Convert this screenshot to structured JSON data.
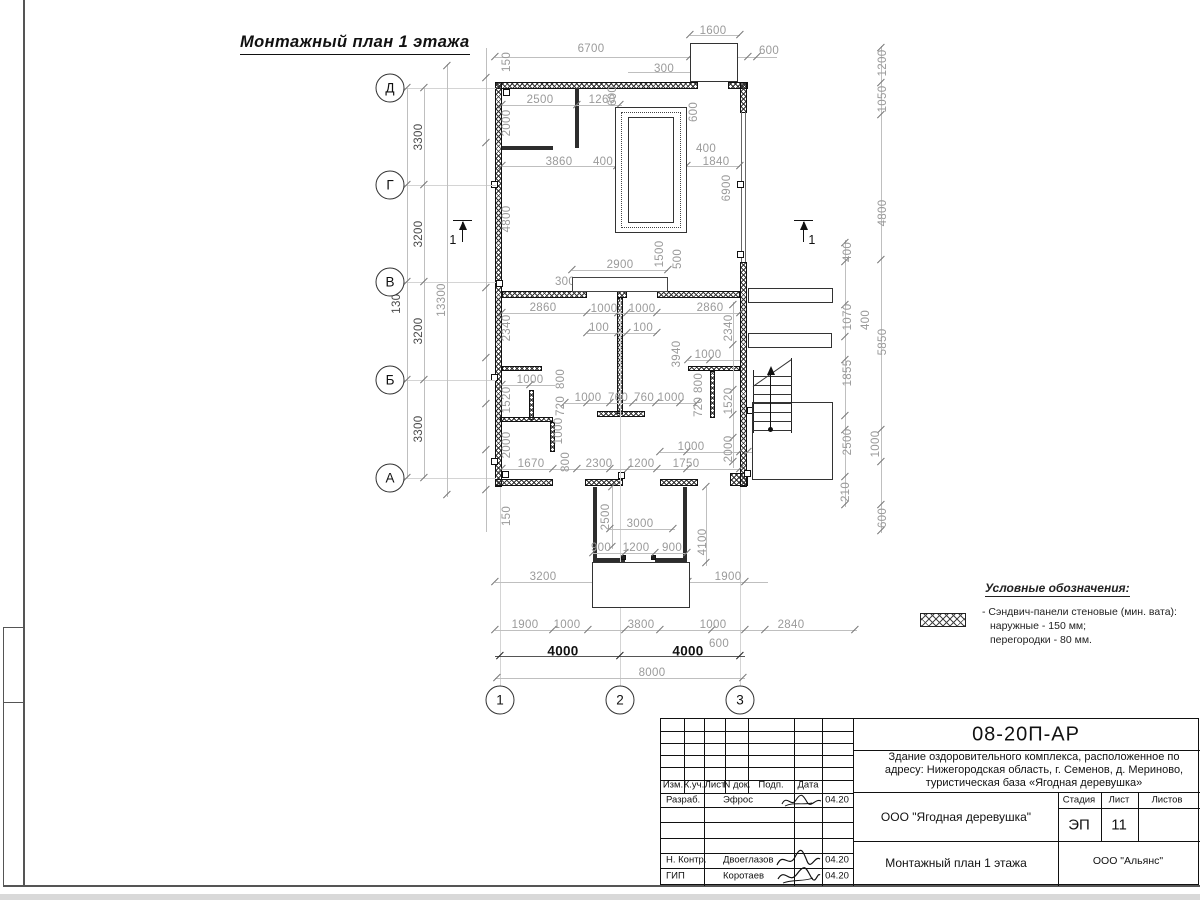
{
  "page": {
    "title": "Монтажный план 1 этажа",
    "section_mark_label": "1"
  },
  "legend": {
    "title": "Условные обозначения:",
    "item_line1": "- Сэндвич-панели стеновые (мин. вата):",
    "item_line2": "наружные - 150 мм;",
    "item_line3": "перегородки - 80 мм.",
    "swatch": "crosshatch-wall-symbol"
  },
  "title_block": {
    "code": "08-20П-АР",
    "project_line1": "Здание оздоровительного комплекса, расположенное по",
    "project_line2": "адресу: Нижегородская область, г. Семенов, д. Мериново,",
    "project_line3": "туристическая база «Ягодная деревушка»",
    "client": "ООО \"Ягодная деревушка\"",
    "stage_label": "Стадия",
    "sheet_label": "Лист",
    "sheets_label": "Листов",
    "stage": "ЭП",
    "sheet": "11",
    "drawing_title": "Монтажный план 1 этажа",
    "company": "ООО \"Альянс\"",
    "header": {
      "izm": "Изм.",
      "kuch": "К.уч.",
      "list": "Лист",
      "ndok": "N док.",
      "podp": "Подп.",
      "data": "Дата"
    },
    "rows": [
      {
        "role": "Разраб.",
        "name": "Эфрос",
        "date": "04.20"
      },
      {
        "role": "Н. Контр.",
        "name": "Двоеглазов",
        "date": "04.20"
      },
      {
        "role": "ГИП",
        "name": "Коротаев",
        "date": "04.20"
      }
    ]
  },
  "plan": {
    "axes": {
      "rows": [
        {
          "label": "Д",
          "y": 88
        },
        {
          "label": "Г",
          "y": 185
        },
        {
          "label": "В",
          "y": 282
        },
        {
          "label": "Б",
          "y": 380
        },
        {
          "label": "А",
          "y": 478
        }
      ],
      "cols": [
        {
          "label": "1",
          "x": 500
        },
        {
          "label": "2",
          "x": 620
        },
        {
          "label": "3",
          "x": 740
        }
      ]
    },
    "dimensions": [
      {
        "t": "3300",
        "x": 419,
        "y": 137,
        "r": 1,
        "s": "d"
      },
      {
        "t": "3200",
        "x": 419,
        "y": 234,
        "r": 1,
        "s": "d"
      },
      {
        "t": "3200",
        "x": 419,
        "y": 331,
        "r": 1,
        "s": "d"
      },
      {
        "t": "3300",
        "x": 419,
        "y": 429,
        "r": 1,
        "s": "d"
      },
      {
        "t": "13000",
        "x": 397,
        "y": 297,
        "r": 1,
        "s": "d"
      },
      {
        "t": "13300",
        "x": 442,
        "y": 300,
        "r": 1
      },
      {
        "t": "150",
        "x": 507,
        "y": 62,
        "r": 1
      },
      {
        "t": "2000",
        "x": 507,
        "y": 123,
        "r": 1
      },
      {
        "t": "4800",
        "x": 507,
        "y": 219,
        "r": 1
      },
      {
        "t": "2340",
        "x": 507,
        "y": 328,
        "r": 1
      },
      {
        "t": "1520",
        "x": 507,
        "y": 400,
        "r": 1
      },
      {
        "t": "2000",
        "x": 507,
        "y": 445,
        "r": 1
      },
      {
        "t": "150",
        "x": 507,
        "y": 516,
        "r": 1
      },
      {
        "t": "1600",
        "x": 713,
        "y": 31
      },
      {
        "t": "6700",
        "x": 591,
        "y": 49
      },
      {
        "t": "1000",
        "x": 712,
        "y": 51
      },
      {
        "t": "600",
        "x": 769,
        "y": 51
      },
      {
        "t": "300",
        "x": 664,
        "y": 69
      },
      {
        "t": "2500",
        "x": 540,
        "y": 100
      },
      {
        "t": "1260",
        "x": 602,
        "y": 100
      },
      {
        "t": "600",
        "x": 613,
        "y": 96,
        "r": 1
      },
      {
        "t": "600",
        "x": 694,
        "y": 112,
        "r": 1
      },
      {
        "t": "3860",
        "x": 559,
        "y": 162
      },
      {
        "t": "400",
        "x": 603,
        "y": 162
      },
      {
        "t": "1500",
        "x": 655,
        "y": 162
      },
      {
        "t": "400",
        "x": 706,
        "y": 149
      },
      {
        "t": "1840",
        "x": 716,
        "y": 162
      },
      {
        "t": "400",
        "x": 647,
        "y": 136,
        "r": 1
      },
      {
        "t": "3500",
        "x": 661,
        "y": 141,
        "r": 1
      },
      {
        "t": "400",
        "x": 662,
        "y": 209,
        "r": 1
      },
      {
        "t": "6900",
        "x": 727,
        "y": 188,
        "r": 1
      },
      {
        "t": "1500",
        "x": 660,
        "y": 254,
        "r": 1
      },
      {
        "t": "500",
        "x": 678,
        "y": 259,
        "r": 1
      },
      {
        "t": "2900",
        "x": 620,
        "y": 265
      },
      {
        "t": "300",
        "x": 565,
        "y": 282
      },
      {
        "t": "2860",
        "x": 543,
        "y": 308
      },
      {
        "t": "1000",
        "x": 604,
        "y": 309
      },
      {
        "t": "1000",
        "x": 642,
        "y": 309
      },
      {
        "t": "2860",
        "x": 710,
        "y": 308
      },
      {
        "t": "100",
        "x": 599,
        "y": 328
      },
      {
        "t": "100",
        "x": 643,
        "y": 328
      },
      {
        "t": "2340",
        "x": 729,
        "y": 328,
        "r": 1
      },
      {
        "t": "3940",
        "x": 677,
        "y": 354,
        "r": 1
      },
      {
        "t": "1000",
        "x": 708,
        "y": 355
      },
      {
        "t": "1000",
        "x": 530,
        "y": 380
      },
      {
        "t": "800",
        "x": 561,
        "y": 379,
        "r": 1
      },
      {
        "t": "720",
        "x": 561,
        "y": 406,
        "r": 1
      },
      {
        "t": "1000",
        "x": 588,
        "y": 398
      },
      {
        "t": "760",
        "x": 618,
        "y": 398
      },
      {
        "t": "760",
        "x": 644,
        "y": 398
      },
      {
        "t": "1000",
        "x": 671,
        "y": 398
      },
      {
        "t": "800",
        "x": 699,
        "y": 383,
        "r": 1
      },
      {
        "t": "720",
        "x": 699,
        "y": 407,
        "r": 1
      },
      {
        "t": "1520",
        "x": 729,
        "y": 401,
        "r": 1
      },
      {
        "t": "1000",
        "x": 559,
        "y": 431,
        "r": 1
      },
      {
        "t": "1670",
        "x": 531,
        "y": 464
      },
      {
        "t": "800",
        "x": 566,
        "y": 462,
        "r": 1
      },
      {
        "t": "2300",
        "x": 599,
        "y": 464
      },
      {
        "t": "1200",
        "x": 641,
        "y": 464
      },
      {
        "t": "1750",
        "x": 686,
        "y": 464
      },
      {
        "t": "1000",
        "x": 691,
        "y": 447
      },
      {
        "t": "2000",
        "x": 729,
        "y": 449,
        "r": 1
      },
      {
        "t": "2500",
        "x": 606,
        "y": 517,
        "r": 1
      },
      {
        "t": "3000",
        "x": 640,
        "y": 524
      },
      {
        "t": "900",
        "x": 601,
        "y": 548
      },
      {
        "t": "1200",
        "x": 636,
        "y": 548
      },
      {
        "t": "900",
        "x": 672,
        "y": 548
      },
      {
        "t": "4100",
        "x": 703,
        "y": 542,
        "r": 1
      },
      {
        "t": "3200",
        "x": 543,
        "y": 577
      },
      {
        "t": "3200",
        "x": 641,
        "y": 577
      },
      {
        "t": "1900",
        "x": 728,
        "y": 577
      },
      {
        "t": "1900",
        "x": 525,
        "y": 625
      },
      {
        "t": "1000",
        "x": 567,
        "y": 625
      },
      {
        "t": "3800",
        "x": 641,
        "y": 625
      },
      {
        "t": "1000",
        "x": 713,
        "y": 625
      },
      {
        "t": "2840",
        "x": 791,
        "y": 625
      },
      {
        "t": "600",
        "x": 719,
        "y": 644
      },
      {
        "t": "4000",
        "x": 563,
        "y": 651,
        "s": "b"
      },
      {
        "t": "4000",
        "x": 688,
        "y": 651,
        "s": "b"
      },
      {
        "t": "8000",
        "x": 652,
        "y": 673
      },
      {
        "t": "1200",
        "x": 883,
        "y": 63,
        "r": 1
      },
      {
        "t": "1050",
        "x": 883,
        "y": 99,
        "r": 1
      },
      {
        "t": "4800",
        "x": 883,
        "y": 213,
        "r": 1
      },
      {
        "t": "5850",
        "x": 883,
        "y": 342,
        "r": 1
      },
      {
        "t": "1000",
        "x": 876,
        "y": 444,
        "r": 1
      },
      {
        "t": "600",
        "x": 883,
        "y": 518,
        "r": 1
      },
      {
        "t": "400",
        "x": 848,
        "y": 252,
        "r": 1
      },
      {
        "t": "1070",
        "x": 848,
        "y": 317,
        "r": 1
      },
      {
        "t": "400",
        "x": 866,
        "y": 320,
        "r": 1
      },
      {
        "t": "1855",
        "x": 848,
        "y": 373,
        "r": 1
      },
      {
        "t": "2500",
        "x": 848,
        "y": 442,
        "r": 1
      },
      {
        "t": "210",
        "x": 846,
        "y": 492,
        "r": 1
      },
      {
        "t": "1200",
        "x": 770,
        "y": 448
      },
      {
        "t": "200",
        "x": 772,
        "y": 461
      },
      {
        "t": "1555",
        "x": 804,
        "y": 454,
        "r": 1
      }
    ]
  }
}
